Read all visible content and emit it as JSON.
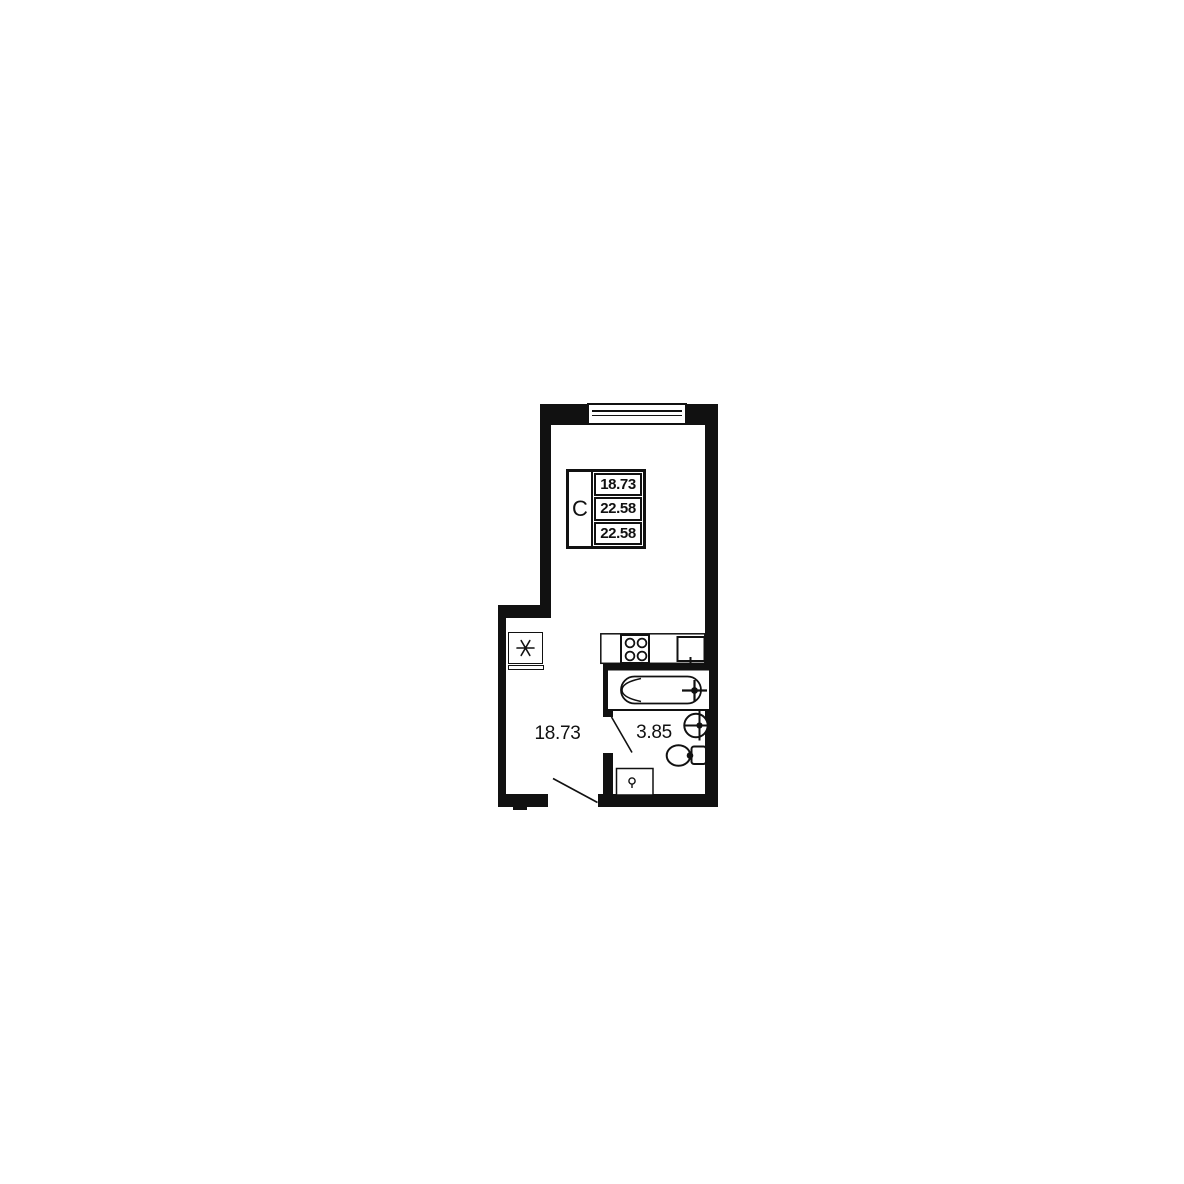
{
  "colors": {
    "ink": "#111111",
    "background": "#ffffff"
  },
  "info_box": {
    "type_label": "С",
    "rows": [
      {
        "value": "18.73"
      },
      {
        "value": "22.58"
      },
      {
        "value": "22.58"
      }
    ]
  },
  "rooms": {
    "main": {
      "area": "18.73"
    },
    "bathroom": {
      "area": "3.85"
    }
  },
  "fixtures": [
    "window",
    "vent-shaft-asterisk",
    "kitchen-counter",
    "stove",
    "kitchen-sink",
    "bathtub",
    "washbasin",
    "toilet",
    "washing-machine",
    "entrance-door-swing",
    "bathroom-door-swing"
  ]
}
